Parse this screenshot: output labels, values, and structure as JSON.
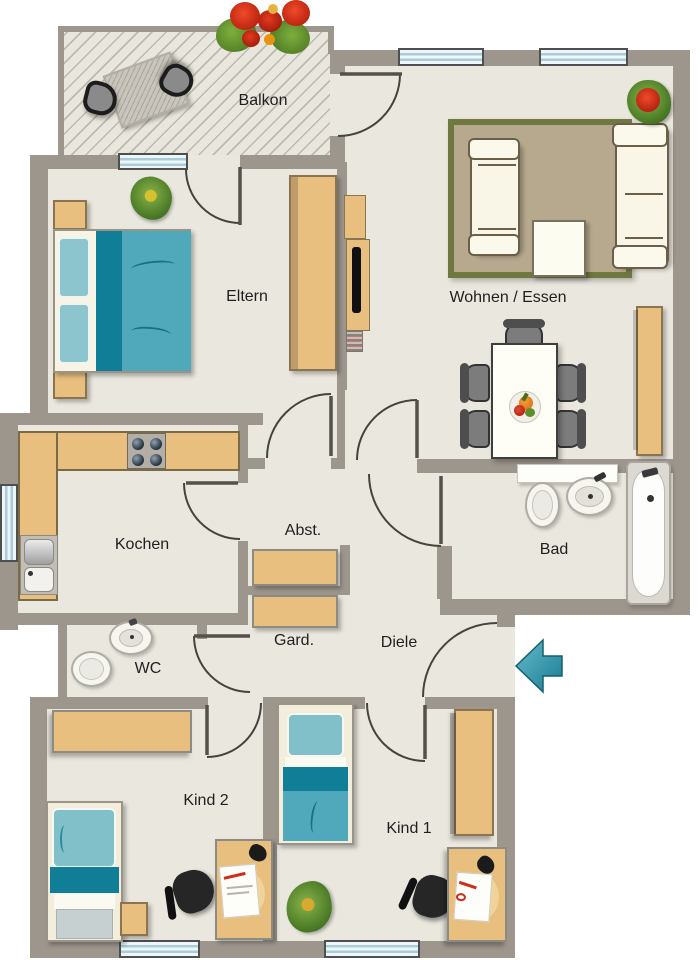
{
  "floorplan": {
    "type": "apartment-floorplan",
    "rooms": [
      {
        "id": "balkon",
        "label": "Balkon"
      },
      {
        "id": "eltern",
        "label": "Eltern"
      },
      {
        "id": "wohnen_essen",
        "label": "Wohnen / Essen"
      },
      {
        "id": "kochen",
        "label": "Kochen"
      },
      {
        "id": "abst",
        "label": "Abst."
      },
      {
        "id": "bad",
        "label": "Bad"
      },
      {
        "id": "wc",
        "label": "WC"
      },
      {
        "id": "gard",
        "label": "Gard."
      },
      {
        "id": "diele",
        "label": "Diele"
      },
      {
        "id": "kind2",
        "label": "Kind 2"
      },
      {
        "id": "kind1",
        "label": "Kind 1"
      }
    ],
    "entry": {
      "symbol": "arrow",
      "direction": "left"
    },
    "colors": {
      "wall": "#9d968d",
      "floor": "#eae7de",
      "wood": "#e9bf80",
      "textile_teal": "#4fa9ba",
      "textile_teal_dark": "#117e97",
      "window_glass": "#d8ecf2",
      "rug_border": "#6e7840",
      "rug_fill": "#b7a98e",
      "entry_arrow": "#2f93a8"
    },
    "furniture": [
      "balcony-table",
      "balcony-chairs",
      "flower-box",
      "double-bed",
      "nightstand",
      "wardrobe",
      "tv-board",
      "sofa-2-seat",
      "sofa-3-seat",
      "coffee-table",
      "rug",
      "dining-table",
      "dining-chairs",
      "fruit-bowl",
      "sideboard",
      "kitchen-counter",
      "stove",
      "kitchen-sink",
      "storage-shelf",
      "coat-shelf",
      "wc-sink",
      "wc-toilet",
      "bath-shelf",
      "bath-toilet",
      "bath-sink",
      "bathtub",
      "single-bed",
      "desk",
      "desk-chair",
      "plant"
    ]
  }
}
